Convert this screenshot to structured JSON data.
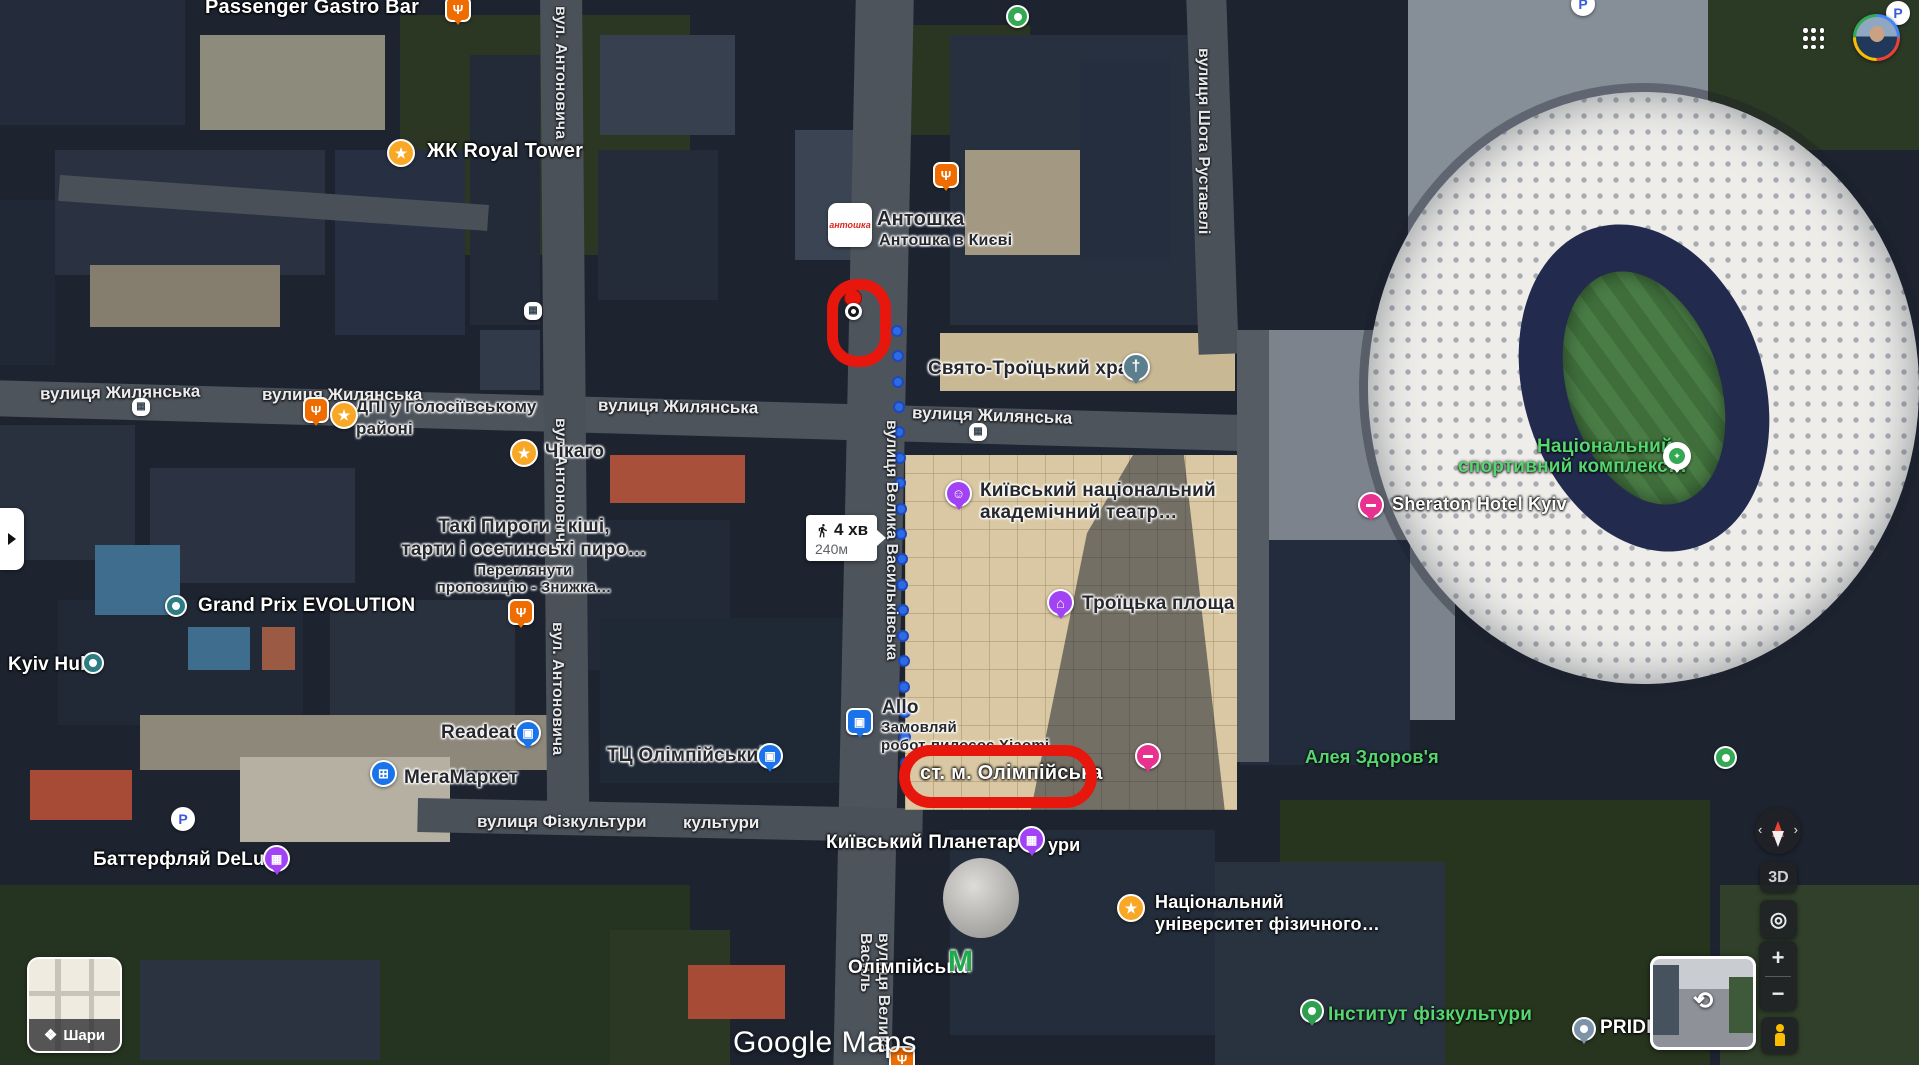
{
  "palette": {
    "route_blue": "#2e6be0",
    "annotation_red": "#e8170d",
    "label_green": "#55d66f",
    "poi_purple": "#a142f4",
    "poi_blue": "#1a73e8",
    "poi_orange": "#ef6c00",
    "star_yellow": "#f9a825",
    "hotel_pink": "#e9318f",
    "metro_green": "#1faa4b",
    "teal": "#2d7d82",
    "church_teal": "#5b7f8d",
    "green_poi": "#34a853",
    "gray_pin": "#7d93a8"
  },
  "ui": {
    "layers_label": "Шари",
    "logo": "Google Maps",
    "btn_3d": "3D",
    "zoom_in": "+",
    "zoom_out": "−",
    "walk": {
      "time": "4 хв",
      "dist": "240м"
    }
  },
  "map": {
    "street_labels_h": [
      {
        "text": "вулиця Жилянська",
        "x": 40,
        "y": 383,
        "angle": -1,
        "size": 17
      },
      {
        "text": "вулиця Жилянська",
        "x": 262,
        "y": 385,
        "angle": 0,
        "size": 17
      },
      {
        "text": "вулиця Жилянська",
        "x": 598,
        "y": 397,
        "angle": 1,
        "size": 17
      },
      {
        "text": "вулиця Жилянська",
        "x": 912,
        "y": 406,
        "angle": 2,
        "size": 17
      },
      {
        "text": "вулиця Фізкультури",
        "x": 477,
        "y": 812,
        "angle": 0,
        "size": 17
      },
      {
        "text": "культури",
        "x": 683,
        "y": 813,
        "angle": 0,
        "size": 17
      }
    ],
    "street_labels_v": [
      {
        "text": "вул. Антоновича",
        "x": 551,
        "y": 6,
        "h": 152,
        "size": 16
      },
      {
        "text": "вул. Антоновича",
        "x": 551,
        "y": 418,
        "h": 150,
        "size": 16
      },
      {
        "text": "вул. Антоновича",
        "x": 548,
        "y": 622,
        "h": 152,
        "size": 16
      },
      {
        "text": "вулиця Шота Руставелі",
        "x": 1194,
        "y": 48,
        "h": 228,
        "size": 16
      },
      {
        "text": "вулиця Велика Васильківська",
        "x": 882,
        "y": 420,
        "h": 348,
        "size": 16
      },
      {
        "text": "вулиця Велика Василь",
        "x": 856,
        "y": 933,
        "h": 132,
        "size": 16
      }
    ],
    "poi_labels": [
      {
        "text": "Passenger Gastro Bar",
        "x": 205,
        "y": -4,
        "style": "light",
        "size": 20
      },
      {
        "text": "ЖК Royal Tower",
        "x": 427,
        "y": 140,
        "style": "light",
        "size": 20
      },
      {
        "text": "Антошка",
        "x": 877,
        "y": 208,
        "style": "dark",
        "size": 20
      },
      {
        "text": "Антошка в Києві",
        "x": 879,
        "y": 232,
        "style": "dark",
        "size": 16
      },
      {
        "text": "Свято-Троїцький храм",
        "x": 928,
        "y": 358,
        "style": "dark",
        "size": 19
      },
      {
        "text": "ДПІ у Голосіївському",
        "x": 356,
        "y": 397,
        "style": "dark",
        "size": 17
      },
      {
        "text": "районі",
        "x": 356,
        "y": 419,
        "style": "dark",
        "size": 17
      },
      {
        "text": "Чікаго",
        "x": 545,
        "y": 441,
        "style": "dark",
        "size": 19
      },
      {
        "text": "Такі Пироги - кіші,",
        "x": 524,
        "y": 516,
        "style": "dark",
        "size": 19,
        "center": true
      },
      {
        "text": "тарти і осетинські пиро…",
        "x": 524,
        "y": 539,
        "style": "dark",
        "size": 19,
        "center": true
      },
      {
        "text": "Переглянути",
        "x": 524,
        "y": 562,
        "style": "dark",
        "size": 15,
        "center": true
      },
      {
        "text": "пропозицію - Знижка…",
        "x": 524,
        "y": 579,
        "style": "dark",
        "size": 15,
        "center": true
      },
      {
        "text": "Grand Prix EVOLUTION",
        "x": 198,
        "y": 595,
        "style": "light",
        "size": 19
      },
      {
        "text": "Kyiv Hub",
        "x": 8,
        "y": 654,
        "style": "light",
        "size": 19
      },
      {
        "text": "Readeat",
        "x": 441,
        "y": 722,
        "style": "dark",
        "size": 19
      },
      {
        "text": "МегаМаркет",
        "x": 404,
        "y": 767,
        "style": "dark",
        "size": 19
      },
      {
        "text": "ТЦ Олімпійський",
        "x": 607,
        "y": 745,
        "style": "dark",
        "size": 19
      },
      {
        "text": "Allo",
        "x": 882,
        "y": 697,
        "style": "dark",
        "size": 19
      },
      {
        "text": "Замовляй",
        "x": 881,
        "y": 719,
        "style": "dark",
        "size": 15
      },
      {
        "text": "робот-пилосос Xiaomi",
        "x": 881,
        "y": 737,
        "style": "dark",
        "size": 15
      },
      {
        "text": "ст. м. Олімпійська",
        "x": 920,
        "y": 762,
        "style": "light",
        "size": 20
      },
      {
        "text": "Київський національний",
        "x": 980,
        "y": 480,
        "style": "dark",
        "size": 19
      },
      {
        "text": "академічний театр…",
        "x": 980,
        "y": 502,
        "style": "dark",
        "size": 19
      },
      {
        "text": "Троїцька площа",
        "x": 1082,
        "y": 593,
        "style": "dark",
        "size": 19
      },
      {
        "text": "Sheraton Hotel Kyiv",
        "x": 1392,
        "y": 494,
        "style": "light",
        "size": 18
      },
      {
        "text": "Національний",
        "x": 1537,
        "y": 436,
        "style": "green",
        "size": 19
      },
      {
        "text": "спортивний комплекс…",
        "x": 1458,
        "y": 456,
        "style": "green",
        "size": 19
      },
      {
        "text": "Алея Здоров'я",
        "x": 1305,
        "y": 747,
        "style": "green",
        "size": 18
      },
      {
        "text": "Національний",
        "x": 1155,
        "y": 892,
        "style": "light",
        "size": 18
      },
      {
        "text": "університет фізичного…",
        "x": 1155,
        "y": 914,
        "style": "light",
        "size": 18
      },
      {
        "text": "Київський Планетарій",
        "x": 826,
        "y": 832,
        "style": "light",
        "size": 19
      },
      {
        "text": "ури",
        "x": 1048,
        "y": 835,
        "style": "light",
        "size": 18
      },
      {
        "text": "Олімпійська",
        "x": 848,
        "y": 957,
        "style": "light",
        "size": 19
      },
      {
        "text": "Інститут фізкультури",
        "x": 1328,
        "y": 1004,
        "style": "green",
        "size": 19
      },
      {
        "text": "PRIDE",
        "x": 1600,
        "y": 1017,
        "style": "light",
        "size": 19
      },
      {
        "text": "Баттерфляй DeLuxe",
        "x": 93,
        "y": 849,
        "style": "light",
        "size": 19
      }
    ],
    "markers": [
      {
        "kind": "restaurant",
        "x": 445,
        "y": -4
      },
      {
        "kind": "restaurant",
        "x": 933,
        "y": 162
      },
      {
        "kind": "restaurant",
        "x": 303,
        "y": 397
      },
      {
        "kind": "restaurant",
        "x": 508,
        "y": 599
      },
      {
        "kind": "restaurant",
        "x": 889,
        "y": 1046
      },
      {
        "kind": "star",
        "x": 387,
        "y": 139
      },
      {
        "kind": "star",
        "x": 330,
        "y": 401
      },
      {
        "kind": "star",
        "x": 510,
        "y": 439
      },
      {
        "kind": "star",
        "x": 1117,
        "y": 894
      },
      {
        "kind": "teal",
        "x": 165,
        "y": 595
      },
      {
        "kind": "teal",
        "x": 82,
        "y": 652
      },
      {
        "kind": "bagpin",
        "x": 515,
        "y": 720
      },
      {
        "kind": "bagpin",
        "x": 757,
        "y": 743
      },
      {
        "kind": "bagsq",
        "x": 846,
        "y": 708
      },
      {
        "kind": "cart",
        "x": 370,
        "y": 760
      },
      {
        "kind": "theater",
        "x": 945,
        "y": 480
      },
      {
        "kind": "landmark",
        "x": 1047,
        "y": 589
      },
      {
        "kind": "film",
        "x": 1018,
        "y": 826
      },
      {
        "kind": "film",
        "x": 263,
        "y": 845
      },
      {
        "kind": "church",
        "x": 1122,
        "y": 353
      },
      {
        "kind": "hotel",
        "x": 1358,
        "y": 492
      },
      {
        "kind": "hotel",
        "x": 1135,
        "y": 743
      },
      {
        "kind": "nscpin",
        "x": 1663,
        "y": 442
      },
      {
        "kind": "greendot",
        "x": 1714,
        "y": 746
      },
      {
        "kind": "greendot",
        "x": 1006,
        "y": 5
      },
      {
        "kind": "greenpin",
        "x": 1300,
        "y": 999
      },
      {
        "kind": "graypin",
        "x": 1572,
        "y": 1017
      },
      {
        "kind": "parking",
        "x": 171,
        "y": 807
      },
      {
        "kind": "parking",
        "x": 1571,
        "y": -8
      },
      {
        "kind": "parking",
        "x": 1886,
        "y": 1
      },
      {
        "kind": "transit",
        "x": 132,
        "y": 398
      },
      {
        "kind": "transit",
        "x": 969,
        "y": 423
      },
      {
        "kind": "transit",
        "x": 524,
        "y": 302
      }
    ],
    "metro_m": {
      "glyph": "M",
      "x": 948,
      "y": 947
    },
    "antoshka_logo_text": "антошка",
    "searched_pin": {
      "x": 844,
      "y": 289
    },
    "route_dots": [
      [
        897,
        331
      ],
      [
        898,
        356
      ],
      [
        898,
        382
      ],
      [
        899,
        407
      ],
      [
        899,
        432
      ],
      [
        900,
        458
      ],
      [
        900,
        483
      ],
      [
        901,
        509
      ],
      [
        901,
        534
      ],
      [
        902,
        559
      ],
      [
        902,
        585
      ],
      [
        903,
        610
      ],
      [
        903,
        636
      ],
      [
        904,
        661
      ],
      [
        904,
        687
      ],
      [
        905,
        712
      ],
      [
        905,
        737
      ],
      [
        906,
        763
      ]
    ],
    "red_annotations": [
      {
        "shape": "rounded-rect",
        "x": 827,
        "y": 279,
        "w": 64,
        "h": 88,
        "r": 30
      },
      {
        "shape": "oval",
        "x": 899,
        "y": 745,
        "w": 198,
        "h": 63,
        "r": 32
      }
    ],
    "walk_tooltip": {
      "x": 806,
      "y": 515
    }
  }
}
